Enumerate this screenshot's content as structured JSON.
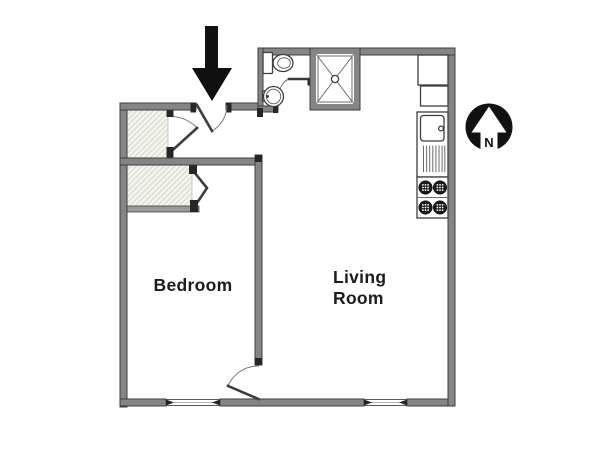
{
  "title": "Apartment floor plan",
  "rooms": {
    "bedroom": {
      "label": "Bedroom"
    },
    "living_room": {
      "lines": [
        "Living",
        "Room"
      ]
    },
    "bathroom": {
      "label": ""
    },
    "hallway": {
      "label": ""
    }
  },
  "compass": {
    "label": "N",
    "direction": "north"
  },
  "entry": {
    "indicator": "down-arrow"
  },
  "fixtures": [
    "toilet",
    "bathroom-sink",
    "shower",
    "bathroom-door",
    "refrigerator",
    "kitchen-cabinet",
    "kitchen-sink",
    "drainboard",
    "stove-burners",
    "hall-closet",
    "bedroom-closet",
    "entry-door",
    "bedroom-door",
    "bedroom-window",
    "living-room-window"
  ],
  "colors": {
    "wall": "#858585",
    "wall_edge": "#3e3e3e",
    "cap": "#262626",
    "line": "#3d3d3d",
    "thin_line": "#6b6b6b",
    "hatch_bg": "#f4f5ef",
    "hatch_line": "#d6d8cd",
    "black": "#111111",
    "text": "#1c1c1c",
    "bg": "#ffffff"
  }
}
